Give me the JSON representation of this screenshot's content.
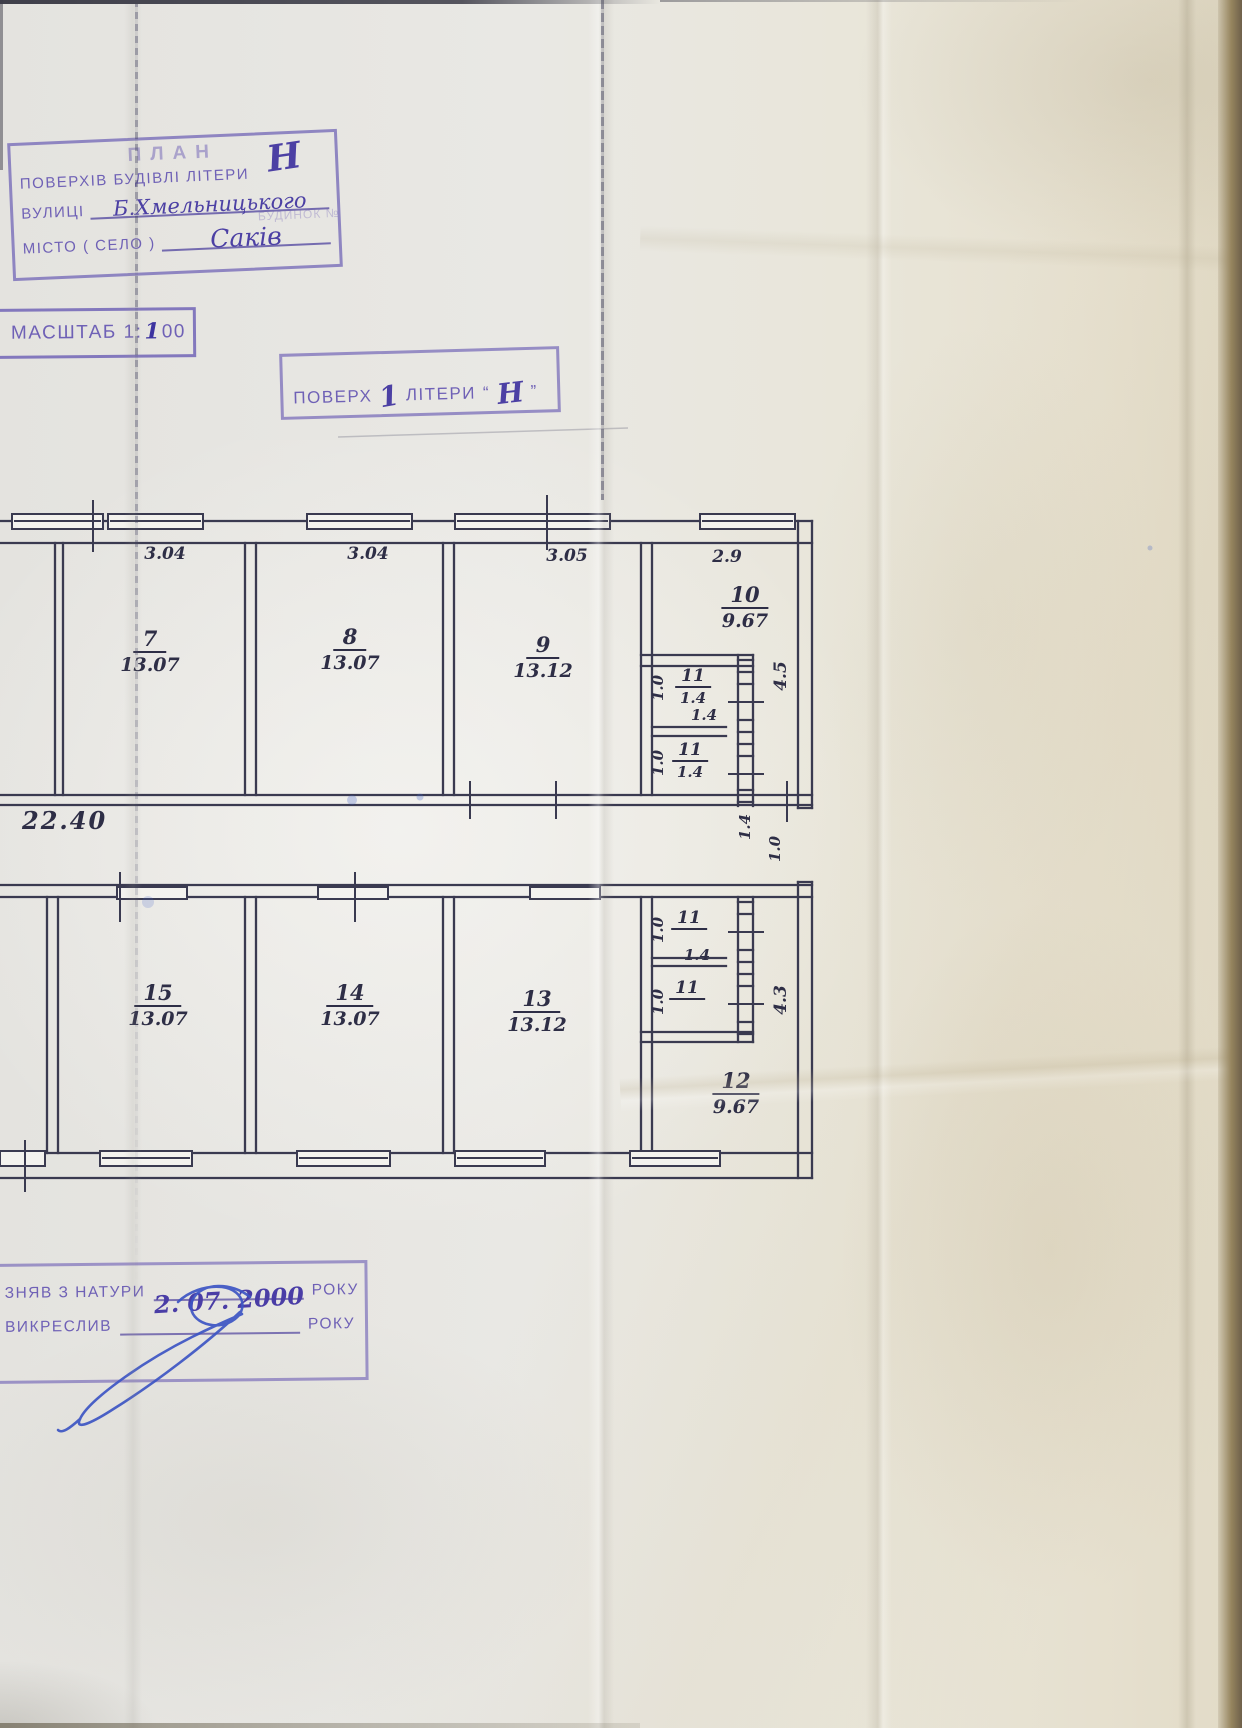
{
  "stamps": {
    "plan": {
      "title": "ПЛАН",
      "floors_label": "ПОВЕРХІВ БУДІВЛІ ЛІТЕРИ",
      "floors_value": "Н",
      "street_label": "ВУЛИЦІ",
      "street_value": "Б.Хмельницького",
      "building_label": "БУДИНОК №",
      "city_label": "МІСТО ( СЕЛО )",
      "city_value": "Саків"
    },
    "scale": {
      "label": "МАСШТАБ 1:",
      "value": "1",
      "suffix": "00"
    },
    "floor": {
      "label": "ПОВЕРХ",
      "floor_value": "1",
      "letter_label": "ЛІТЕРИ",
      "open_quote": "“",
      "letter_value": "Н",
      "close_quote": "”"
    },
    "survey": {
      "line1_label": "ЗНЯВ З НАТУРИ",
      "line1_value": "2. 07. 2000",
      "line1_suffix": "РОКУ",
      "line2_label": "ВИКРЕСЛИВ",
      "line2_suffix": "РОКУ"
    }
  },
  "plan": {
    "top_dims": [
      "3.04",
      "3.04",
      "3.05",
      "2.9"
    ],
    "corridor_length": "22.40",
    "side_dim_top": "4.5",
    "side_dim_bottom": "4.3",
    "entry_dims": {
      "width": "1.4",
      "depth": "1.0"
    },
    "wc_dims": {
      "t1_width": "1.4",
      "b1_width": "1.4",
      "t1_depth": "1.0",
      "t2_depth": "1.0",
      "b1_depth": "1.0",
      "b2_depth": "1.0"
    },
    "rooms": {
      "r7": {
        "num": "7",
        "area": "13.07"
      },
      "r8": {
        "num": "8",
        "area": "13.07"
      },
      "r9": {
        "num": "9",
        "area": "13.12"
      },
      "r10": {
        "num": "10",
        "area": "9.67"
      },
      "wc_t1": {
        "num": "11",
        "area": "1.4"
      },
      "wc_t2": {
        "num": "11",
        "area": "1.4"
      },
      "r15": {
        "num": "15",
        "area": "13.07"
      },
      "r14": {
        "num": "14",
        "area": "13.07"
      },
      "r13": {
        "num": "13",
        "area": "13.12"
      },
      "wc_b1": {
        "num": "11",
        "area": ""
      },
      "wc_b2": {
        "num": "11",
        "area": ""
      },
      "r12": {
        "num": "12",
        "area": "9.67"
      }
    }
  }
}
